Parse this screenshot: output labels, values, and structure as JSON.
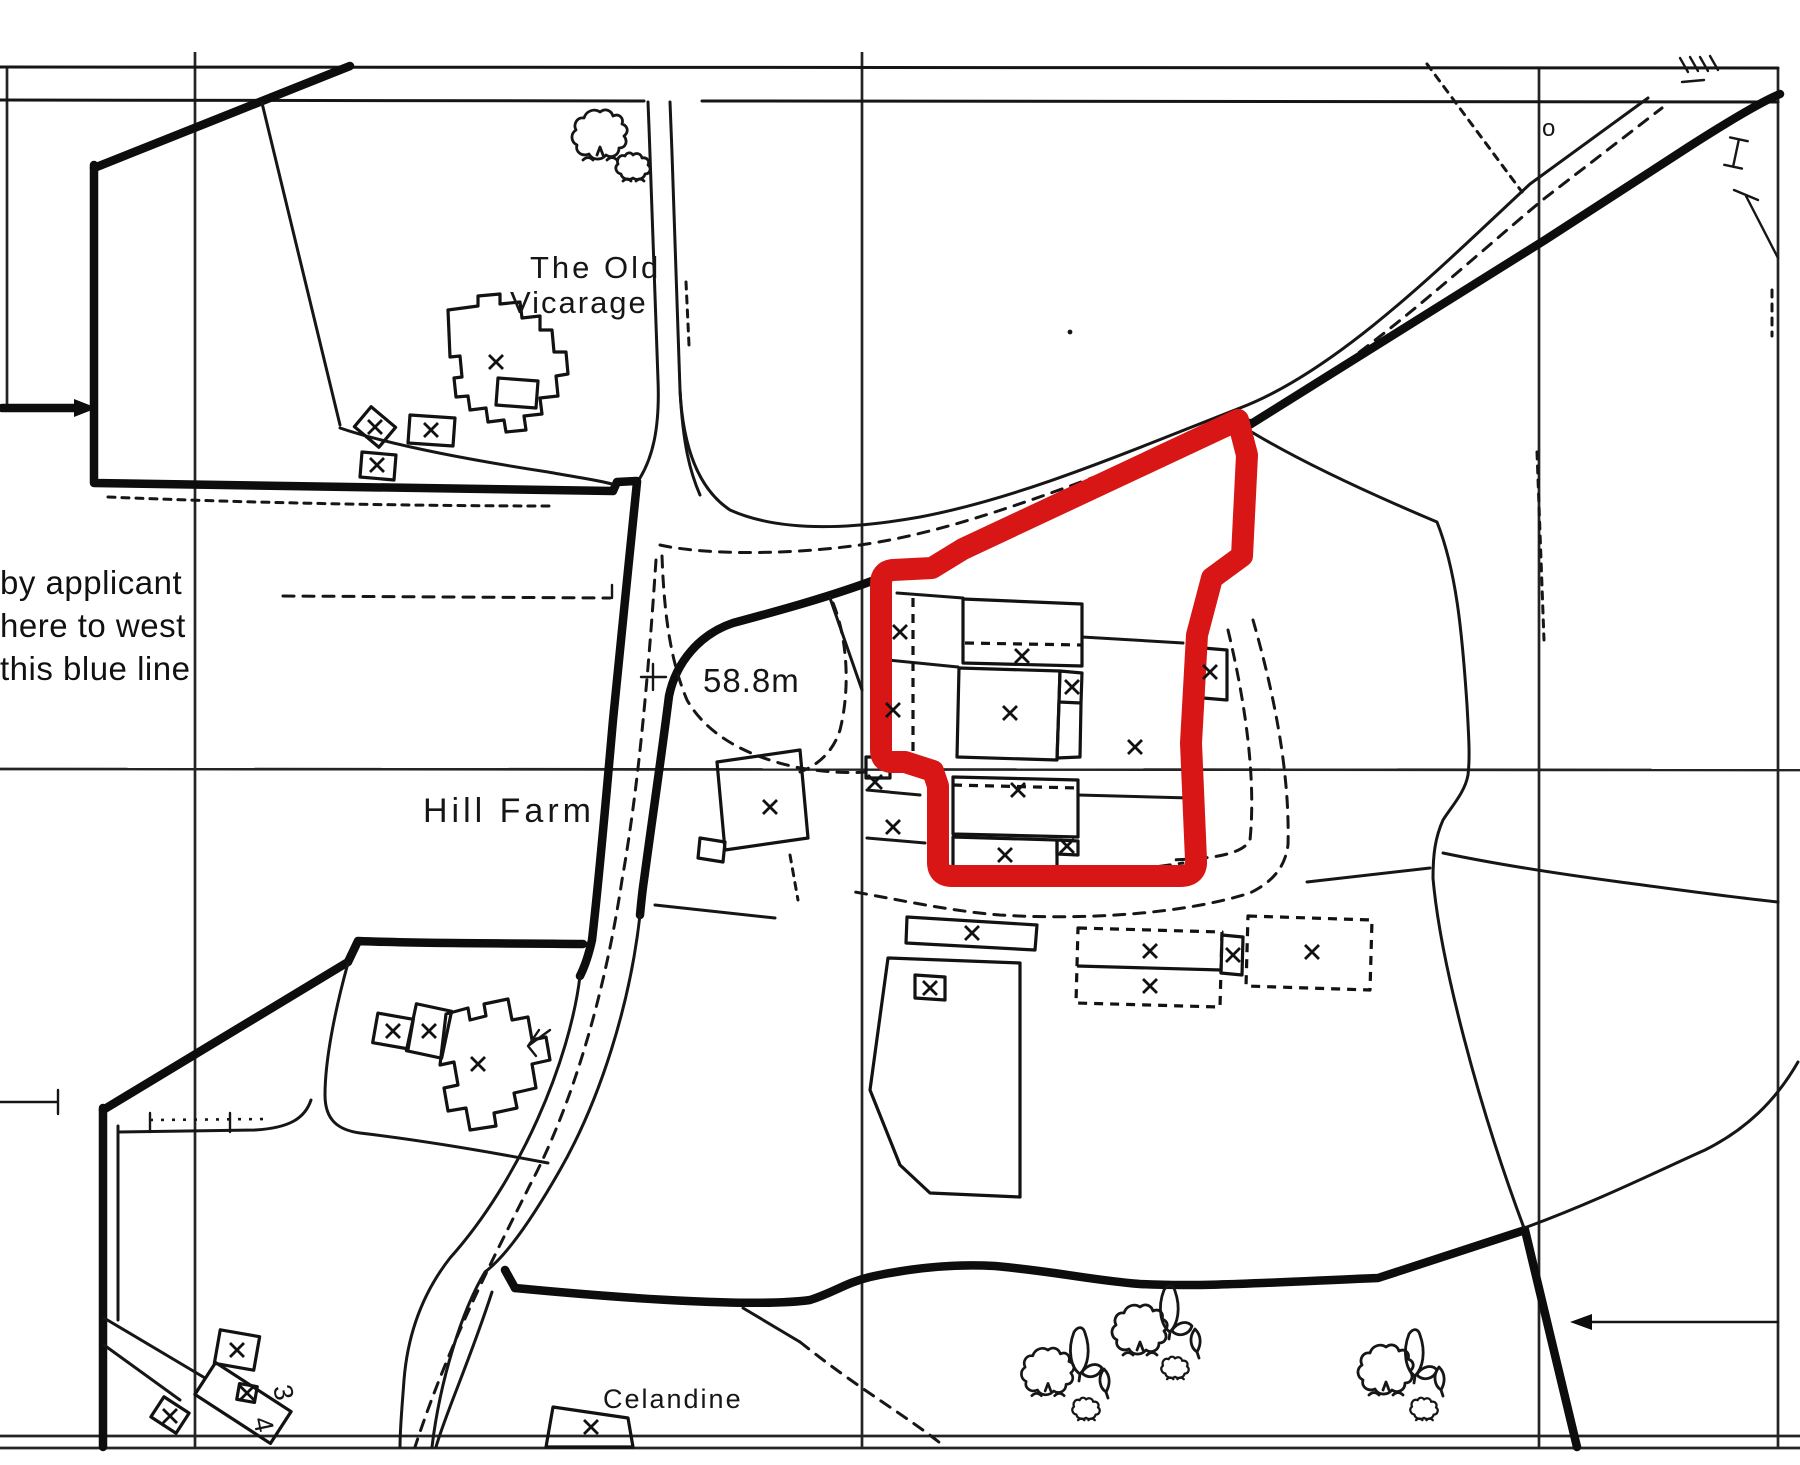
{
  "document": {
    "kind": "scanned site location plan",
    "background": "#ffffff"
  },
  "colors": {
    "site_boundary_red": "#d81616",
    "ink": "#161616"
  },
  "annotation_left": {
    "line1": "by applicant",
    "line2": "here to west",
    "line3": "this blue line"
  },
  "labels": {
    "property_old_vicarage_line1": "The Old",
    "property_old_vicarage_line2": "Vicarage",
    "farm_name": "Hill Farm",
    "spot_height": "58.8m",
    "property_celandine": "Celandine",
    "house_number_3": "3",
    "house_number_4": "4",
    "small_circle": "o"
  },
  "map": {
    "building_cross_marks": [
      [
        496,
        362
      ],
      [
        375,
        427
      ],
      [
        431,
        430
      ],
      [
        377,
        465
      ],
      [
        900,
        632
      ],
      [
        893,
        710
      ],
      [
        1022,
        656
      ],
      [
        1072,
        687
      ],
      [
        1010,
        713
      ],
      [
        1135,
        747
      ],
      [
        1210,
        672
      ],
      [
        875,
        782
      ],
      [
        1018,
        790
      ],
      [
        893,
        827
      ],
      [
        1005,
        855
      ],
      [
        1067,
        846
      ],
      [
        770,
        807
      ],
      [
        972,
        933
      ],
      [
        930,
        988
      ],
      [
        1150,
        951
      ],
      [
        1150,
        986
      ],
      [
        1233,
        955
      ],
      [
        1312,
        952
      ],
      [
        393,
        1031
      ],
      [
        429,
        1031
      ],
      [
        478,
        1064
      ],
      [
        237,
        1350
      ],
      [
        247,
        1393
      ],
      [
        170,
        1416
      ],
      [
        591,
        1427
      ]
    ],
    "trees": [
      {
        "type": "tree",
        "x": 600,
        "y": 134,
        "s": 1.0
      },
      {
        "type": "shrub",
        "x": 633,
        "y": 167,
        "s": 1.0
      },
      {
        "type": "tree",
        "x": 1048,
        "y": 1371,
        "s": 0.95
      },
      {
        "type": "sapling",
        "x": 1080,
        "y": 1368,
        "s": 1.0
      },
      {
        "type": "shrub",
        "x": 1086,
        "y": 1409,
        "s": 0.8
      },
      {
        "type": "halfleaf",
        "x": 1106,
        "y": 1384,
        "s": 1.0
      },
      {
        "type": "tree",
        "x": 1140,
        "y": 1329,
        "s": 1.0
      },
      {
        "type": "sapling",
        "x": 1170,
        "y": 1326,
        "s": 1.0
      },
      {
        "type": "shrub",
        "x": 1175,
        "y": 1368,
        "s": 0.8
      },
      {
        "type": "halfleaf",
        "x": 1197,
        "y": 1344,
        "s": 1.0
      },
      {
        "type": "tree",
        "x": 1386,
        "y": 1369,
        "s": 1.0
      },
      {
        "type": "sapling",
        "x": 1415,
        "y": 1370,
        "s": 1.0
      },
      {
        "type": "halfleaf",
        "x": 1441,
        "y": 1382,
        "s": 1.0
      },
      {
        "type": "shrub",
        "x": 1424,
        "y": 1409,
        "s": 0.8
      }
    ]
  }
}
